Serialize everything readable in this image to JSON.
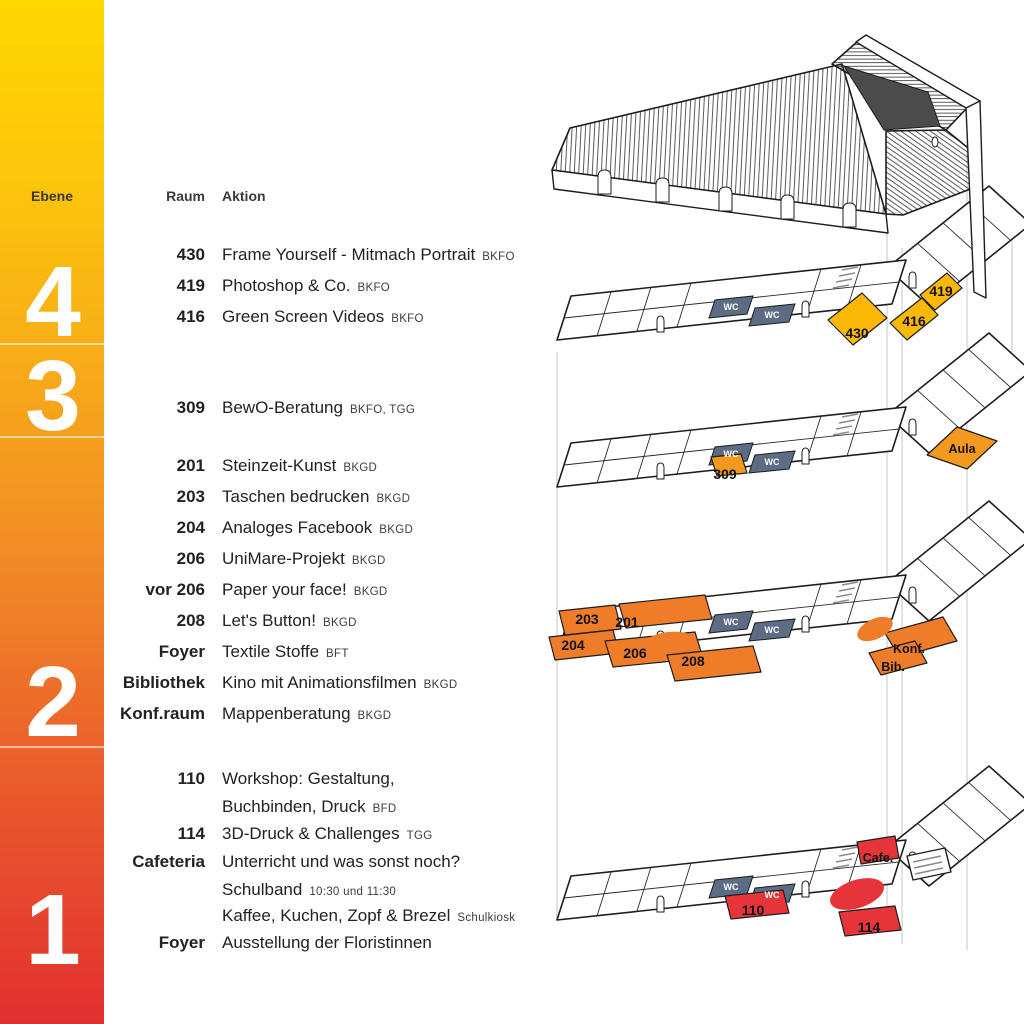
{
  "sidebar": {
    "label": "Ebene",
    "levels": [
      "4",
      "3",
      "2",
      "1"
    ]
  },
  "table": {
    "room_header": "Raum",
    "action_header": "Aktion",
    "levels": [
      {
        "level": "4",
        "rows": [
          {
            "room": "430",
            "action": "Frame Yourself - Mitmach Portrait",
            "tag": "BKFO"
          },
          {
            "room": "419",
            "action": "Photoshop & Co.",
            "tag": "BKFO"
          },
          {
            "room": "416",
            "action": "Green Screen Videos",
            "tag": "BKFO"
          }
        ]
      },
      {
        "level": "3",
        "rows": [
          {
            "room": "309",
            "action": "BewO-Beratung",
            "tag": "BKFO, TGG"
          }
        ]
      },
      {
        "level": "2",
        "rows": [
          {
            "room": "201",
            "action": "Steinzeit-Kunst",
            "tag": "BKGD"
          },
          {
            "room": "203",
            "action": "Taschen bedrucken",
            "tag": "BKGD"
          },
          {
            "room": "204",
            "action": "Analoges Facebook",
            "tag": "BKGD"
          },
          {
            "room": "206",
            "action": "UniMare-Projekt",
            "tag": "BKGD"
          },
          {
            "room": "vor 206",
            "action": "Paper your face!",
            "tag": "BKGD"
          },
          {
            "room": "208",
            "action": "Let's Button!",
            "tag": "BKGD"
          },
          {
            "room": "Foyer",
            "action": "Textile Stoffe",
            "tag": "BFT"
          },
          {
            "room": "Bibliothek",
            "action": "Kino mit Animationsfilmen",
            "tag": "BKGD"
          },
          {
            "room": "Konf.raum",
            "action": "Mappenberatung",
            "tag": "BKGD"
          }
        ]
      },
      {
        "level": "1",
        "rows": [
          {
            "room": "110",
            "action": "Workshop: Gestaltung,",
            "tag": ""
          },
          {
            "room": "",
            "action": "Buchbinden, Druck",
            "tag": "BFD"
          },
          {
            "room": "114",
            "action": "3D-Druck & Challenges",
            "tag": "TGG"
          },
          {
            "room": "Cafeteria",
            "action": "Unterricht und was sonst noch?",
            "tag": ""
          },
          {
            "room": "",
            "action": "Schulband",
            "tag": "10:30 und 11:30"
          },
          {
            "room": "",
            "action": "Kaffee, Kuchen, Zopf & Brezel",
            "tag": "Schulkiosk"
          },
          {
            "room": "Foyer",
            "action": "Ausstellung der Floristinnen",
            "tag": ""
          }
        ]
      }
    ]
  },
  "diagram": {
    "wc": "WC",
    "f4": {
      "r430": "430",
      "r419": "419",
      "r416": "416"
    },
    "f3": {
      "r309": "309",
      "aula": "Aula"
    },
    "f2": {
      "r203": "203",
      "r201": "201",
      "r204": "204",
      "r206": "206",
      "r208": "208",
      "konf": "Konf.",
      "bib": "Bib."
    },
    "f1": {
      "r110": "110",
      "r114": "114",
      "cafe": "Cafe."
    }
  },
  "colors": {
    "level4_yellow": "#FBB807",
    "level3_orange": "#F2991E",
    "level2_orange": "#EE7C28",
    "level1_red": "#E5343A",
    "wc_slate": "#5B6C84",
    "gradient_top": "#FFD800",
    "gradient_middle": "#F18A26",
    "gradient_bottom": "#E23030"
  }
}
